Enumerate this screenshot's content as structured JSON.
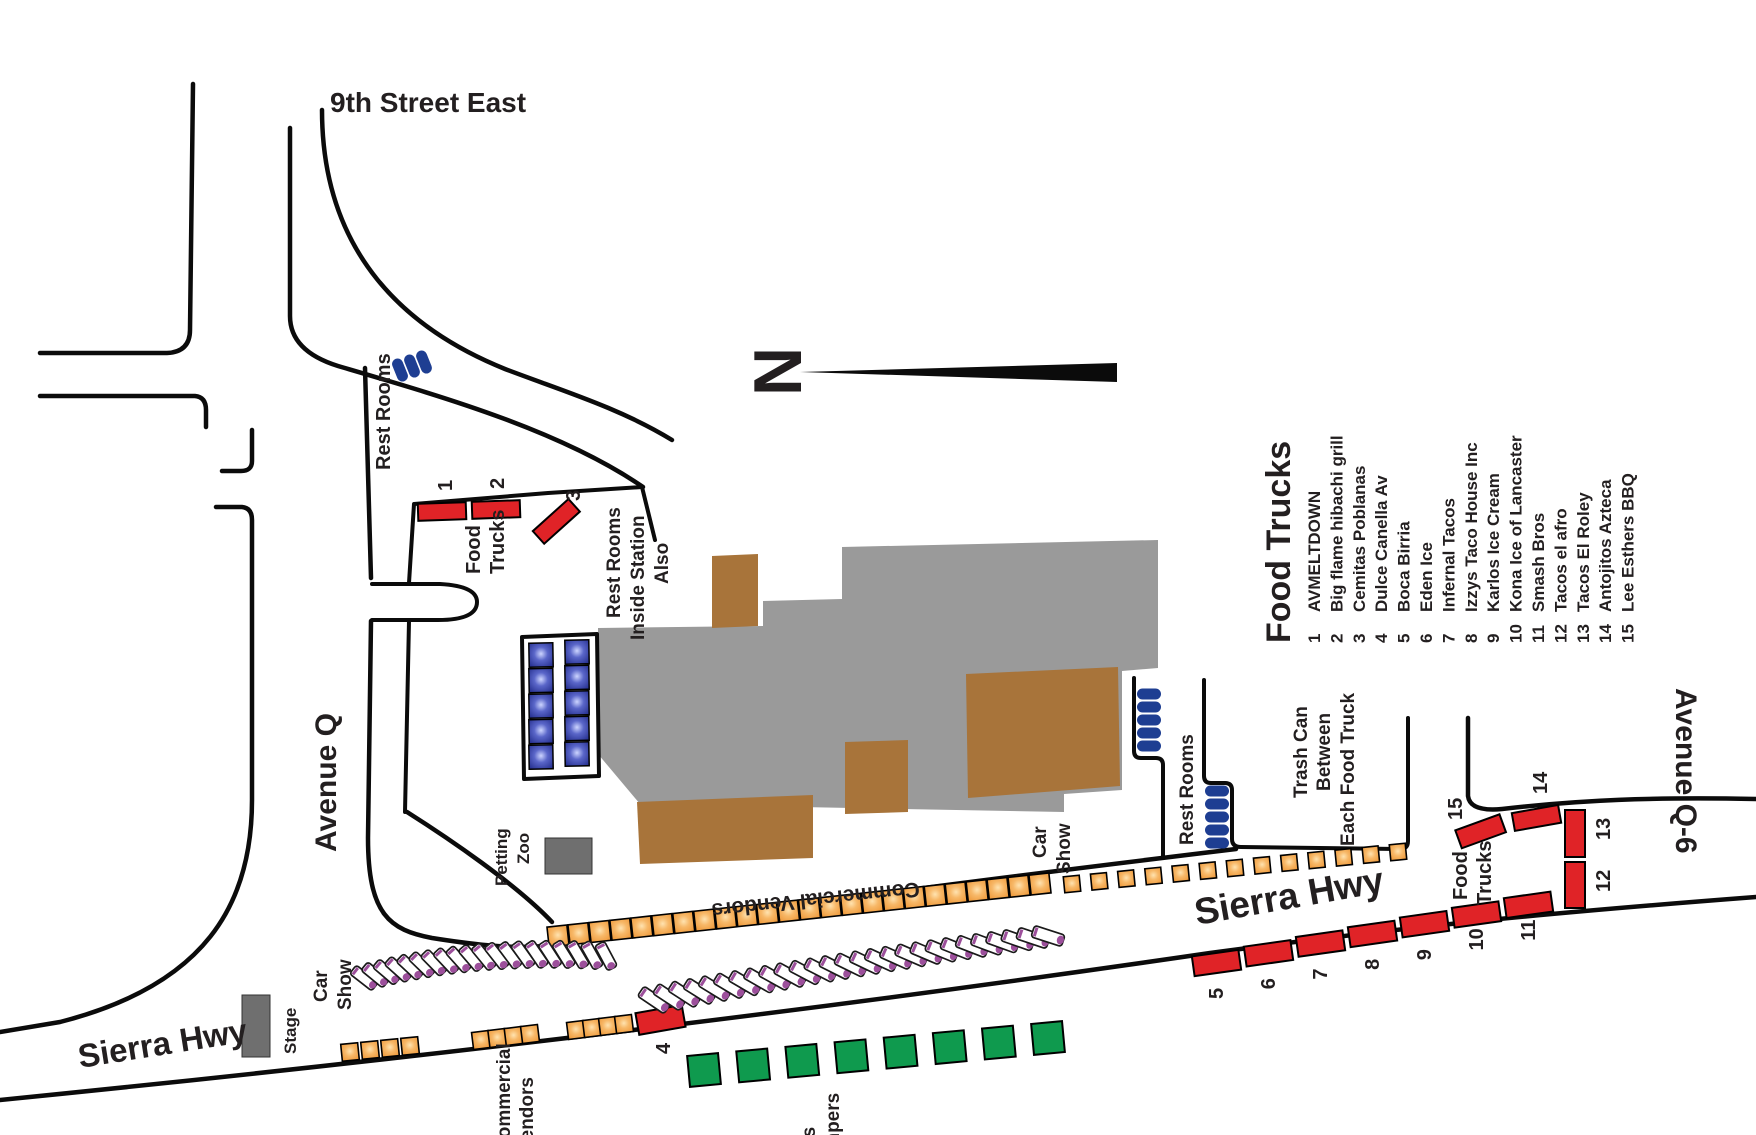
{
  "streets": {
    "ninth": "9th Street East",
    "avenue_q": "Avenue Q",
    "avenue_q6": "Avenue Q-6",
    "sierra_left": "Sierra Hwy",
    "sierra_right": "Sierra Hwy"
  },
  "areas": {
    "north": "N",
    "rest_rooms_top": "Rest Rooms",
    "rest_rooms_right": "Rest Rooms",
    "rest_rooms_station": [
      "Rest Rooms",
      "Inside Station",
      "Also"
    ],
    "food_trucks_left": [
      "Food",
      "Trucks"
    ],
    "food_trucks_right": [
      "Food",
      "Trucks"
    ],
    "trash_can": [
      "Trash Can",
      "Between",
      "Each Food Truck"
    ],
    "car_show": [
      "Car",
      "Show"
    ],
    "petting_zoo": [
      "Petting",
      "Zoo"
    ],
    "stage": "Stage",
    "commercial_vendors": "Commercial Vendors",
    "commercial_vendors_cut": [
      "Commercial",
      "Vendors"
    ],
    "kids_jumpers_cut": [
      "Kids",
      "Jumpers"
    ]
  },
  "legend": {
    "title": "Food Trucks",
    "items": [
      {
        "num": "1",
        "name": "AVMELTDOWN"
      },
      {
        "num": "2",
        "name": "Big flame hibachi grill"
      },
      {
        "num": "3",
        "name": "Cemitas Poblanas"
      },
      {
        "num": "4",
        "name": "Dulce Canella Av"
      },
      {
        "num": "5",
        "name": "Boca Birria"
      },
      {
        "num": "6",
        "name": "Eden Ice"
      },
      {
        "num": "7",
        "name": "Infernal Tacos"
      },
      {
        "num": "8",
        "name": "Izzys Taco House Inc"
      },
      {
        "num": "9",
        "name": "Karlos Ice Cream"
      },
      {
        "num": "10",
        "name": "Kona Ice of Lancaster"
      },
      {
        "num": "11",
        "name": "Smash Bros"
      },
      {
        "num": "12",
        "name": "Tacos el afro"
      },
      {
        "num": "13",
        "name": "Tacos El Roley"
      },
      {
        "num": "14",
        "name": "Antojitos Azteca"
      },
      {
        "num": "15",
        "name": "Lee Esthers BBQ"
      }
    ]
  },
  "truck_numbers": [
    "1",
    "2",
    "3",
    "4",
    "5",
    "6",
    "7",
    "8",
    "9",
    "10",
    "11",
    "12",
    "13",
    "14",
    "15"
  ],
  "colors": {
    "truck_red": "#e02327",
    "vendor_orange": "#f2a24b",
    "jumper_green": "#0f9a4e",
    "restroom_navy": "#1e3e92",
    "building_gray": "#9a9a9a",
    "platform_brown": "#a8743a",
    "stage_gray": "#6f6f6f",
    "car_purple": "#9c4f9b"
  }
}
